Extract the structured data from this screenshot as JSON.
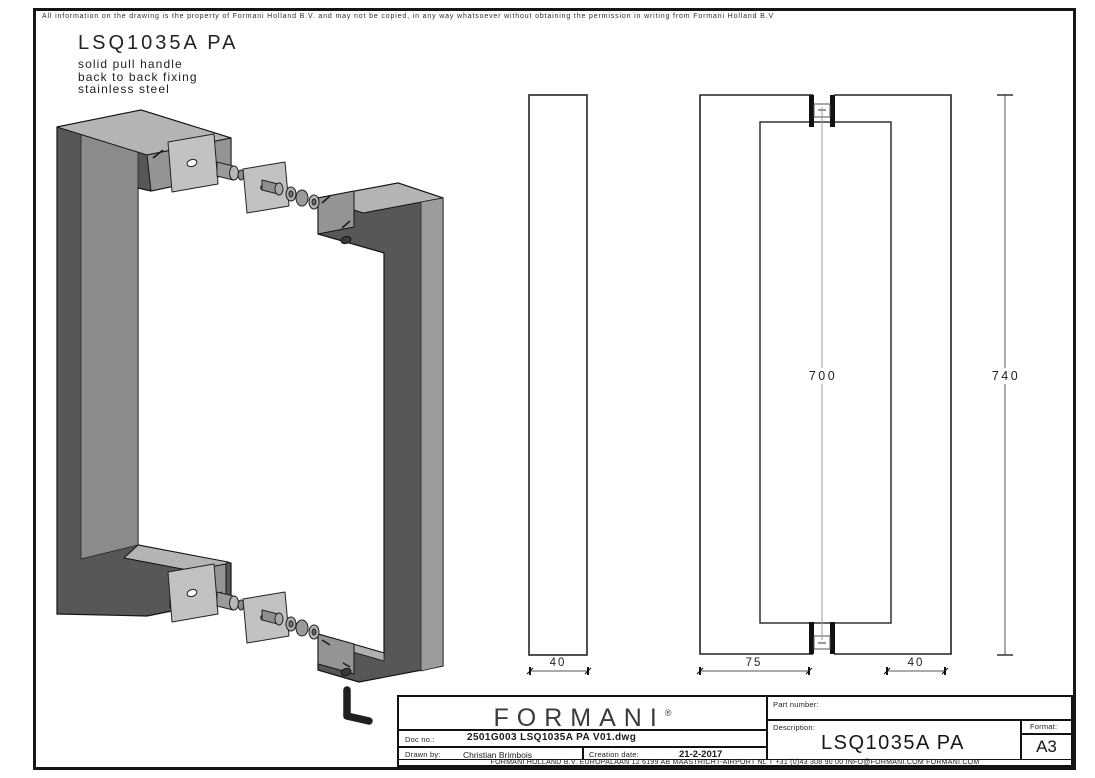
{
  "disclaimer": "All information on the drawing is the property of Formani Holland B.V. and may not be copied, in any way whatsoever without obtaining the permission in writing from Formani Holland B.V",
  "header": {
    "title": "LSQ1035A PA",
    "subtitle_lines": [
      "solid pull handle",
      "back to back fixing",
      "stainless steel"
    ]
  },
  "dimensions": {
    "side_width": "40",
    "front_depth": "75",
    "back_width": "40",
    "center_length": "700",
    "overall_length": "740"
  },
  "title_block": {
    "logo_text": "FORMANI",
    "logo_reg": "®",
    "part_number_label": "Part number:",
    "part_number_value": "",
    "description_label": "Description:",
    "description_value": "LSQ1035A PA",
    "format_label": "Format:",
    "format_value": "A3",
    "doc_no_label": "Doc no.:",
    "doc_no_value": "2501G003 LSQ1035A PA V01.dwg",
    "drawn_by_label": "Drawn by:",
    "drawn_by_value": "Christian Brimbois",
    "creation_date_label": "Creation date:",
    "creation_date_value": "21-2-2017",
    "address": "FORMANI HOLLAND B.V.  EUROPALAAN 12  6199 AB MAASTRICHT-AIRPORT NL  T +31 (0)43 308 90 00 INFO@FORMANI.COM FORMANI.COM"
  }
}
